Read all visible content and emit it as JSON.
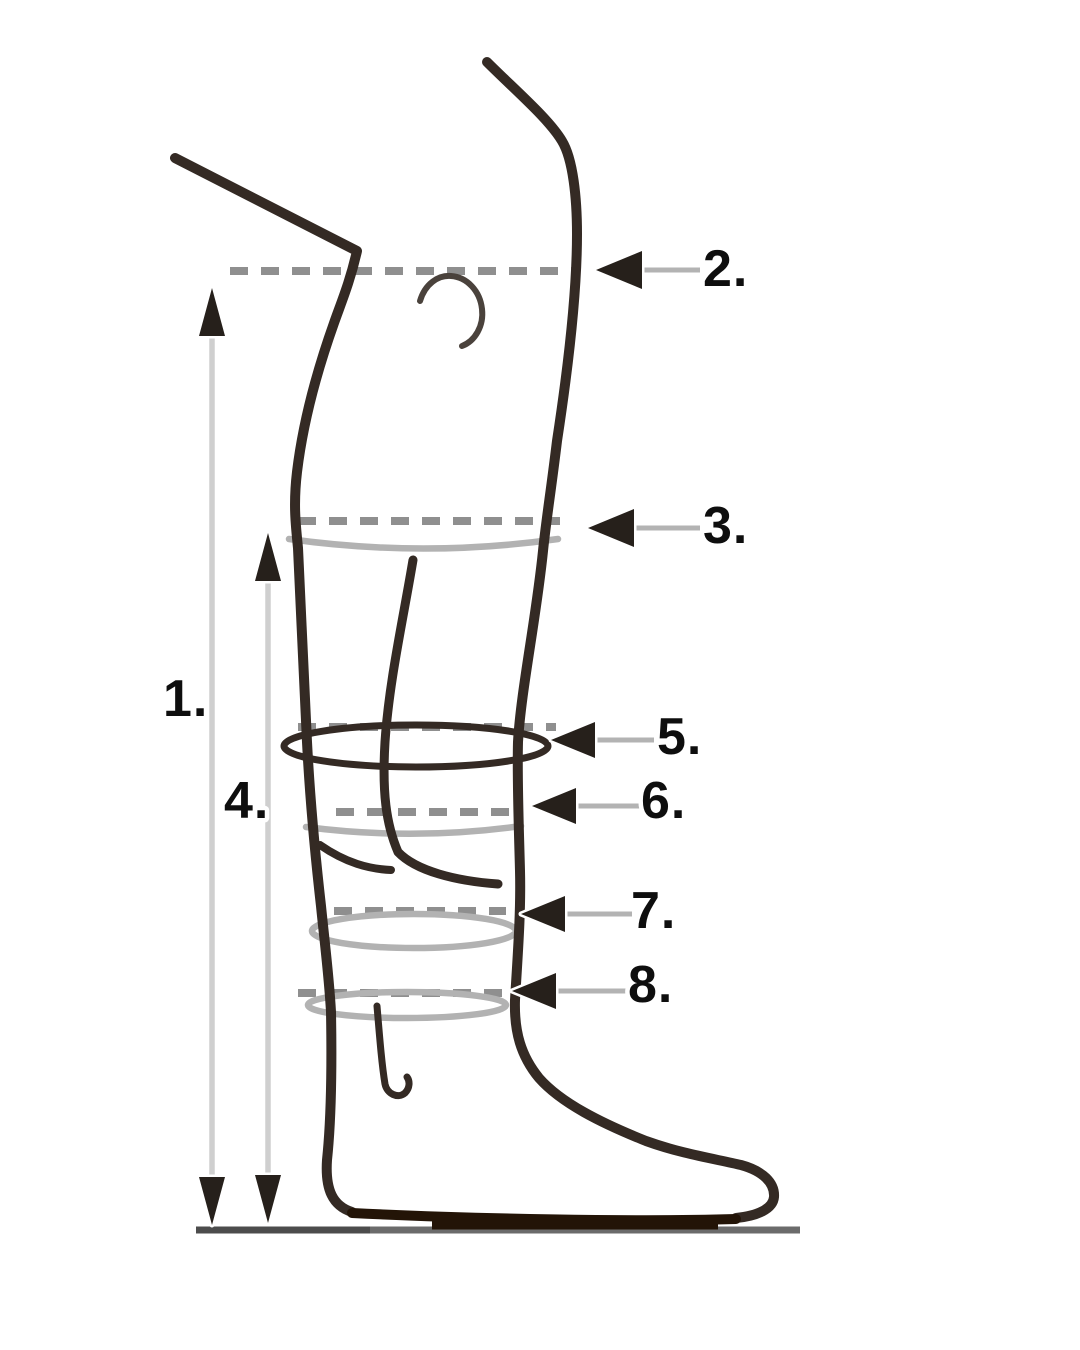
{
  "labels": {
    "l1": "1.",
    "l2": "2.",
    "l3": "3.",
    "l4": "4.",
    "l5": "5.",
    "l6": "6.",
    "l7": "7.",
    "l8": "8."
  },
  "icons": {
    "horizontal_measure_arrow": "left-pointing-triangle-arrow",
    "vertical_measure_arrow": "double-headed-vertical-arrow"
  },
  "colors": {
    "background": "#ffffff",
    "ink": "#342a24",
    "soft_ink": "#4a423c",
    "dash_gray": "#8f8f8f",
    "crease_gray": "#b2b2b2",
    "shaft_gray": "#b3b3b3",
    "shaft_light": "#cfcfcf",
    "arrowhead": "#26201b",
    "ground": "#6b6b6b",
    "ground_dark": "#4c4c4c",
    "sole": "#231407",
    "label": "#0e0e0e"
  }
}
